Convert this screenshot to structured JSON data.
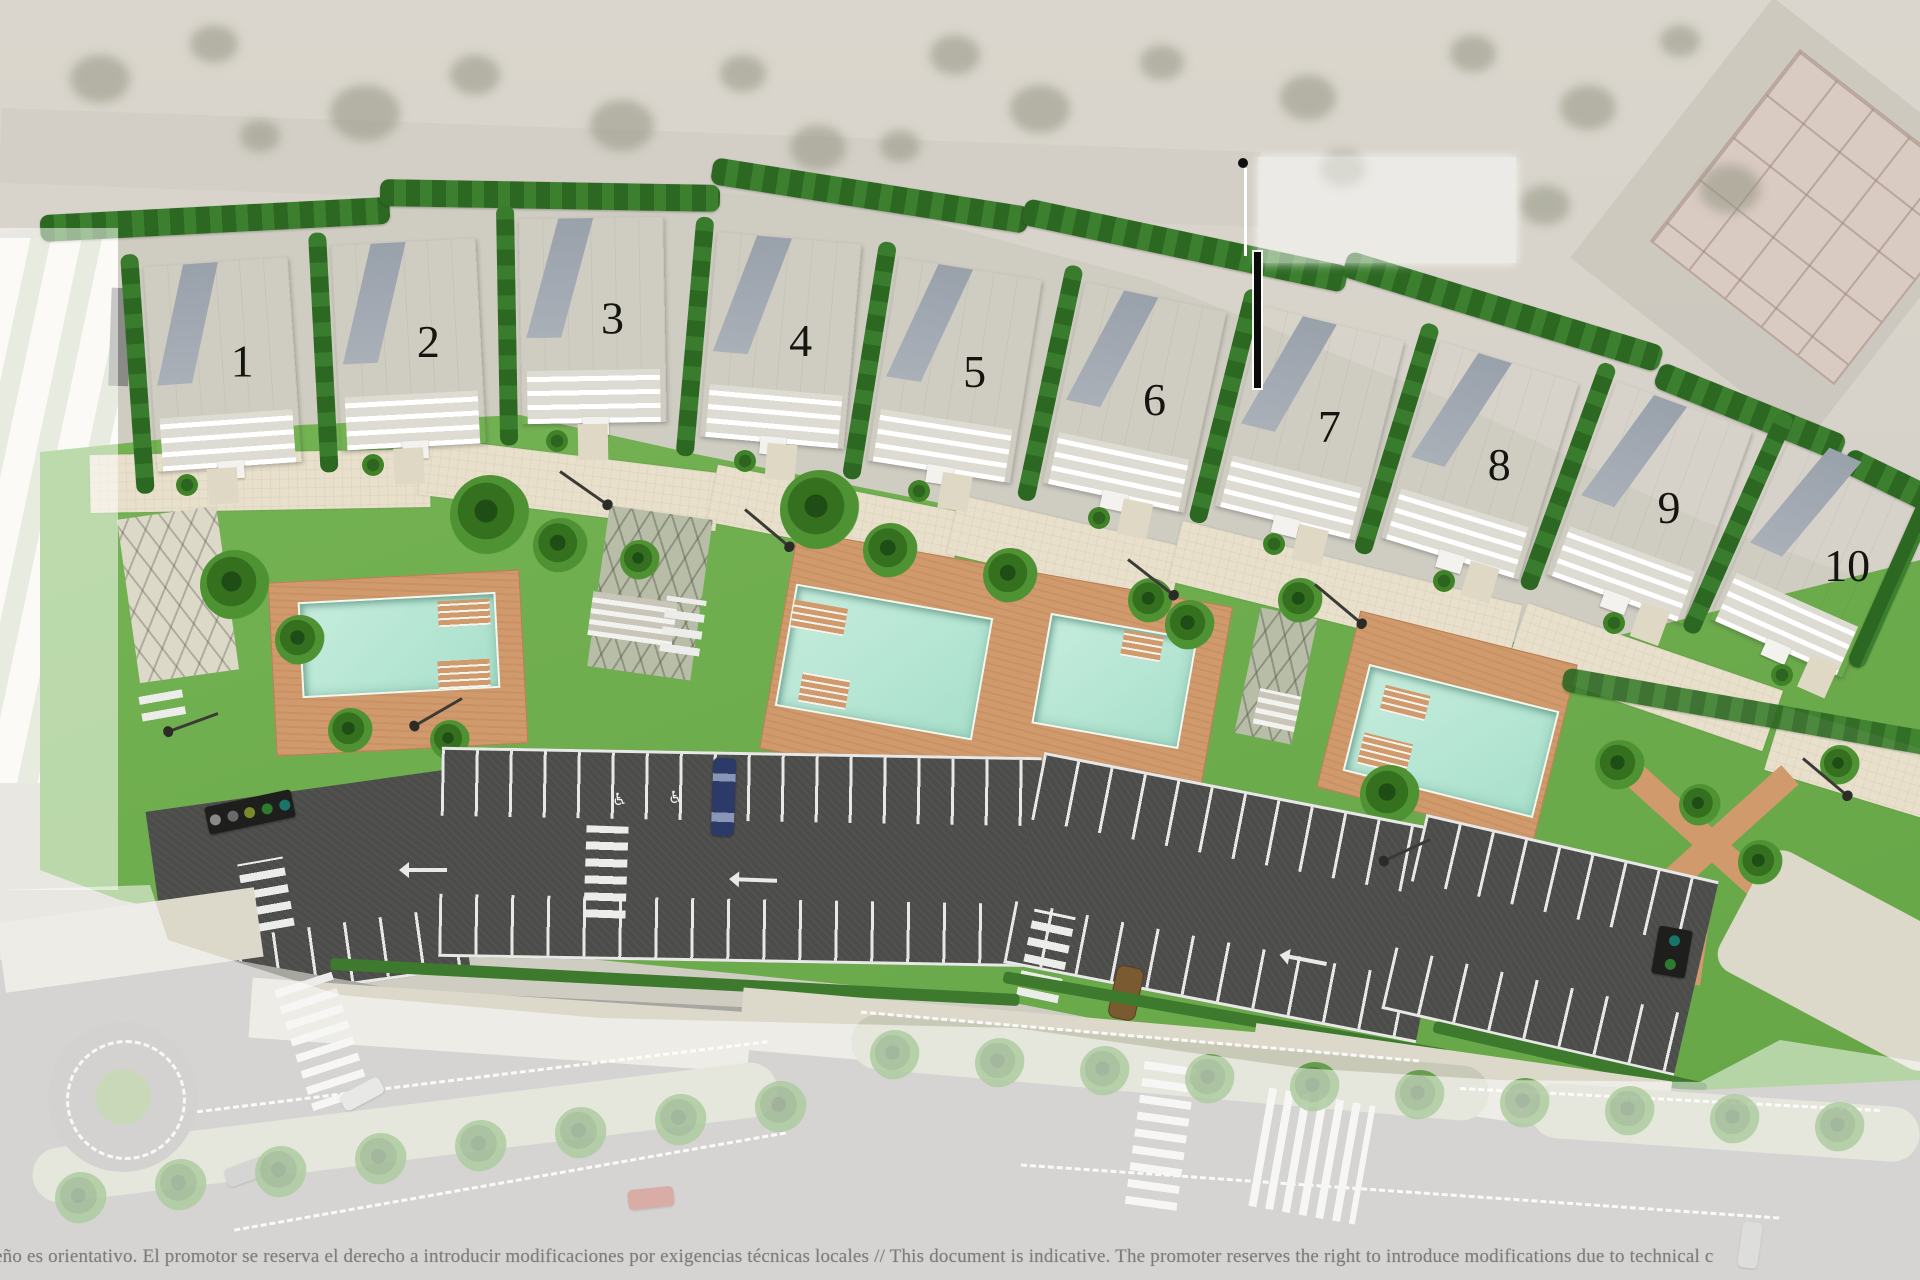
{
  "plan": {
    "building_labels": [
      "1",
      "2",
      "3",
      "4",
      "5",
      "6",
      "7",
      "8",
      "9",
      "10"
    ],
    "disclaimer": "eño es orientativo. El promotor se reserva el derecho a introducir modificaciones por exigencias técnicas locales  //  This document is indicative. The promoter reserves the right to introduce modifications due to technical c",
    "colors": {
      "lawn": "#72b04e",
      "hedge": "#2f6b26",
      "pool_water": "#b5e6d6",
      "pool_deck": "#d09a6c",
      "promenade": "#e8e0cb",
      "asphalt": "#4c4c4a",
      "road_faded": "#a7a6a1",
      "marker": "#000000"
    }
  }
}
